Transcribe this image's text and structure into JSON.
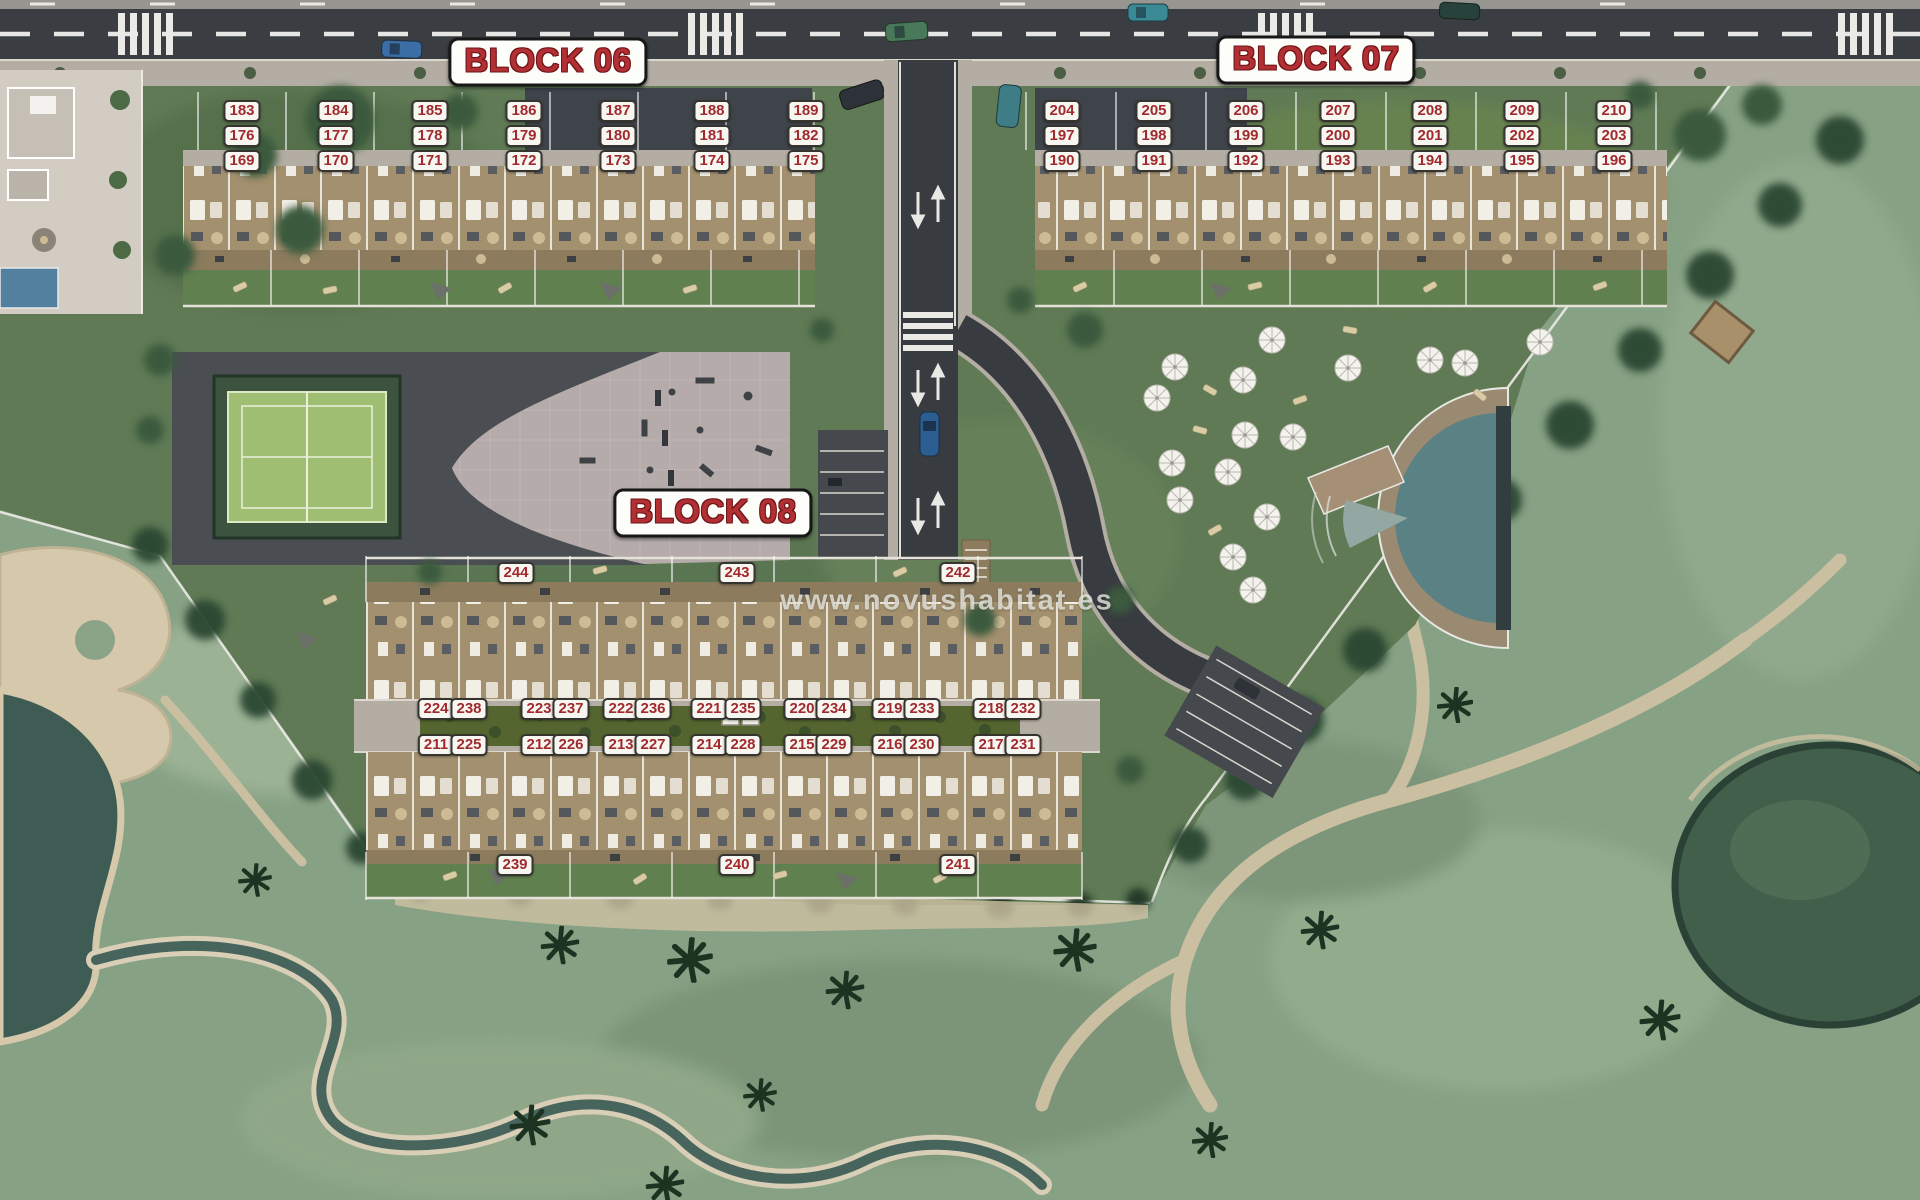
{
  "watermark": {
    "text": "www.novushabitat.es"
  },
  "theme": {
    "badge_red": "#a02a2e",
    "label_red": "#b22f34"
  },
  "blocks": [
    {
      "id": "06",
      "label": "BLOCK 06",
      "label_x": 548,
      "label_y": 62,
      "rows": [
        {
          "y": 111,
          "badges": [
            {
              "n": "183",
              "x": 242
            },
            {
              "n": "184",
              "x": 336
            },
            {
              "n": "185",
              "x": 430
            },
            {
              "n": "186",
              "x": 524
            },
            {
              "n": "187",
              "x": 618
            },
            {
              "n": "188",
              "x": 712
            },
            {
              "n": "189",
              "x": 806
            }
          ]
        },
        {
          "y": 136,
          "badges": [
            {
              "n": "176",
              "x": 242
            },
            {
              "n": "177",
              "x": 336
            },
            {
              "n": "178",
              "x": 430
            },
            {
              "n": "179",
              "x": 524
            },
            {
              "n": "180",
              "x": 618
            },
            {
              "n": "181",
              "x": 712
            },
            {
              "n": "182",
              "x": 806
            }
          ]
        },
        {
          "y": 161,
          "badges": [
            {
              "n": "169",
              "x": 242
            },
            {
              "n": "170",
              "x": 336
            },
            {
              "n": "171",
              "x": 430
            },
            {
              "n": "172",
              "x": 524
            },
            {
              "n": "173",
              "x": 618
            },
            {
              "n": "174",
              "x": 712
            },
            {
              "n": "175",
              "x": 806
            }
          ]
        }
      ]
    },
    {
      "id": "07",
      "label": "BLOCK 07",
      "label_x": 1316,
      "label_y": 60,
      "rows": [
        {
          "y": 111,
          "badges": [
            {
              "n": "204",
              "x": 1062
            },
            {
              "n": "205",
              "x": 1154
            },
            {
              "n": "206",
              "x": 1246
            },
            {
              "n": "207",
              "x": 1338
            },
            {
              "n": "208",
              "x": 1430
            },
            {
              "n": "209",
              "x": 1522
            },
            {
              "n": "210",
              "x": 1614
            }
          ]
        },
        {
          "y": 136,
          "badges": [
            {
              "n": "197",
              "x": 1062
            },
            {
              "n": "198",
              "x": 1154
            },
            {
              "n": "199",
              "x": 1246
            },
            {
              "n": "200",
              "x": 1338
            },
            {
              "n": "201",
              "x": 1430
            },
            {
              "n": "202",
              "x": 1522
            },
            {
              "n": "203",
              "x": 1614
            }
          ]
        },
        {
          "y": 161,
          "badges": [
            {
              "n": "190",
              "x": 1062
            },
            {
              "n": "191",
              "x": 1154
            },
            {
              "n": "192",
              "x": 1246
            },
            {
              "n": "193",
              "x": 1338
            },
            {
              "n": "194",
              "x": 1430
            },
            {
              "n": "195",
              "x": 1522
            },
            {
              "n": "196",
              "x": 1614
            }
          ]
        }
      ]
    },
    {
      "id": "08",
      "label": "BLOCK 08",
      "label_x": 713,
      "label_y": 513,
      "rows": [
        {
          "y": 573,
          "badges": [
            {
              "n": "244",
              "x": 516
            },
            {
              "n": "243",
              "x": 737
            },
            {
              "n": "242",
              "x": 958
            }
          ]
        },
        {
          "y": 709,
          "badges": [
            {
              "n": "224",
              "x": 436
            },
            {
              "n": "238",
              "x": 469
            },
            {
              "n": "223",
              "x": 539
            },
            {
              "n": "237",
              "x": 571
            },
            {
              "n": "222",
              "x": 621
            },
            {
              "n": "236",
              "x": 653
            },
            {
              "n": "221",
              "x": 709
            },
            {
              "n": "235",
              "x": 743
            },
            {
              "n": "220",
              "x": 802
            },
            {
              "n": "234",
              "x": 834
            },
            {
              "n": "219",
              "x": 890
            },
            {
              "n": "233",
              "x": 922
            },
            {
              "n": "218",
              "x": 991
            },
            {
              "n": "232",
              "x": 1023
            }
          ]
        },
        {
          "y": 745,
          "badges": [
            {
              "n": "211",
              "x": 436
            },
            {
              "n": "225",
              "x": 469
            },
            {
              "n": "212",
              "x": 539
            },
            {
              "n": "226",
              "x": 571
            },
            {
              "n": "213",
              "x": 621
            },
            {
              "n": "227",
              "x": 653
            },
            {
              "n": "214",
              "x": 709
            },
            {
              "n": "228",
              "x": 743
            },
            {
              "n": "215",
              "x": 802
            },
            {
              "n": "229",
              "x": 834
            },
            {
              "n": "216",
              "x": 890
            },
            {
              "n": "230",
              "x": 922
            },
            {
              "n": "217",
              "x": 991
            },
            {
              "n": "231",
              "x": 1023
            }
          ]
        },
        {
          "y": 865,
          "badges": [
            {
              "n": "239",
              "x": 515
            },
            {
              "n": "240",
              "x": 737
            },
            {
              "n": "241",
              "x": 958
            }
          ]
        }
      ]
    }
  ]
}
